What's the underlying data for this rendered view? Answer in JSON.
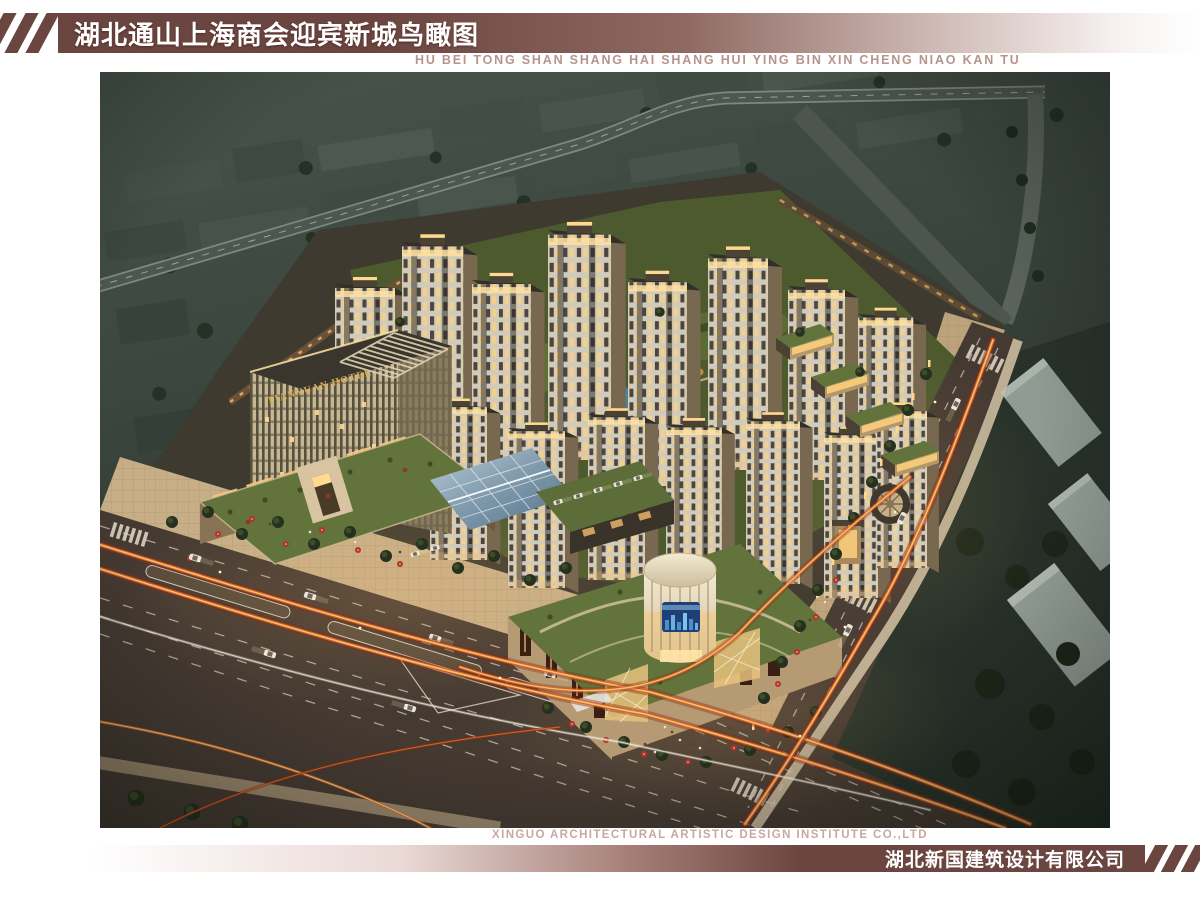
{
  "header": {
    "title_cn": "湖北通山上海商会迎宾新城鸟瞰图",
    "title_pinyin": "HU BEI TONG SHAN SHANG HAI SHANG HUI YING BIN XIN CHENG NIAO KAN TU"
  },
  "render": {
    "hotel_sign": "TIANYUAN HOTEL"
  },
  "footer": {
    "company_en": "XINGUO ARCHITECTURAL ARTISTIC DESIGN INSTITUTE CO.,LTD",
    "company_cn": "湖北新国建筑设计有限公司"
  },
  "colors": {
    "maroon": "#6b4540",
    "title_text": "#ffffff",
    "pinyin_text": "#b5948c",
    "footer_en_text": "#c9a79f",
    "page_bg": "#ffffff",
    "sky_top": "#46524a",
    "sky_bottom": "#242b25",
    "context_block": "#46524a",
    "tower_face": "#d2cbba",
    "tower_side": "#77684f",
    "window_lit": "#ffd17c",
    "green_roof": "#62733b",
    "lawn": "#4d5a2e",
    "plaza_tan": "#c7ae87",
    "promenade_tan": "#bda37c",
    "road_asphalt": "#453a32",
    "trail_red": "#8a2a18",
    "trail_orange": "#d4661f",
    "trail_core": "#ffc37c",
    "lane_line": "#d8cfc0",
    "pond_blue": "#4a8498",
    "drum_cream": "#ecdfc0",
    "glass_blue": "#7e99ab",
    "hotel_face": "#c6b792",
    "hotel_gold": "#dba94a",
    "umbrella_red": "#b23527",
    "storefront_glow": "#ffc87a",
    "screen_blue": "#1e3f77"
  }
}
